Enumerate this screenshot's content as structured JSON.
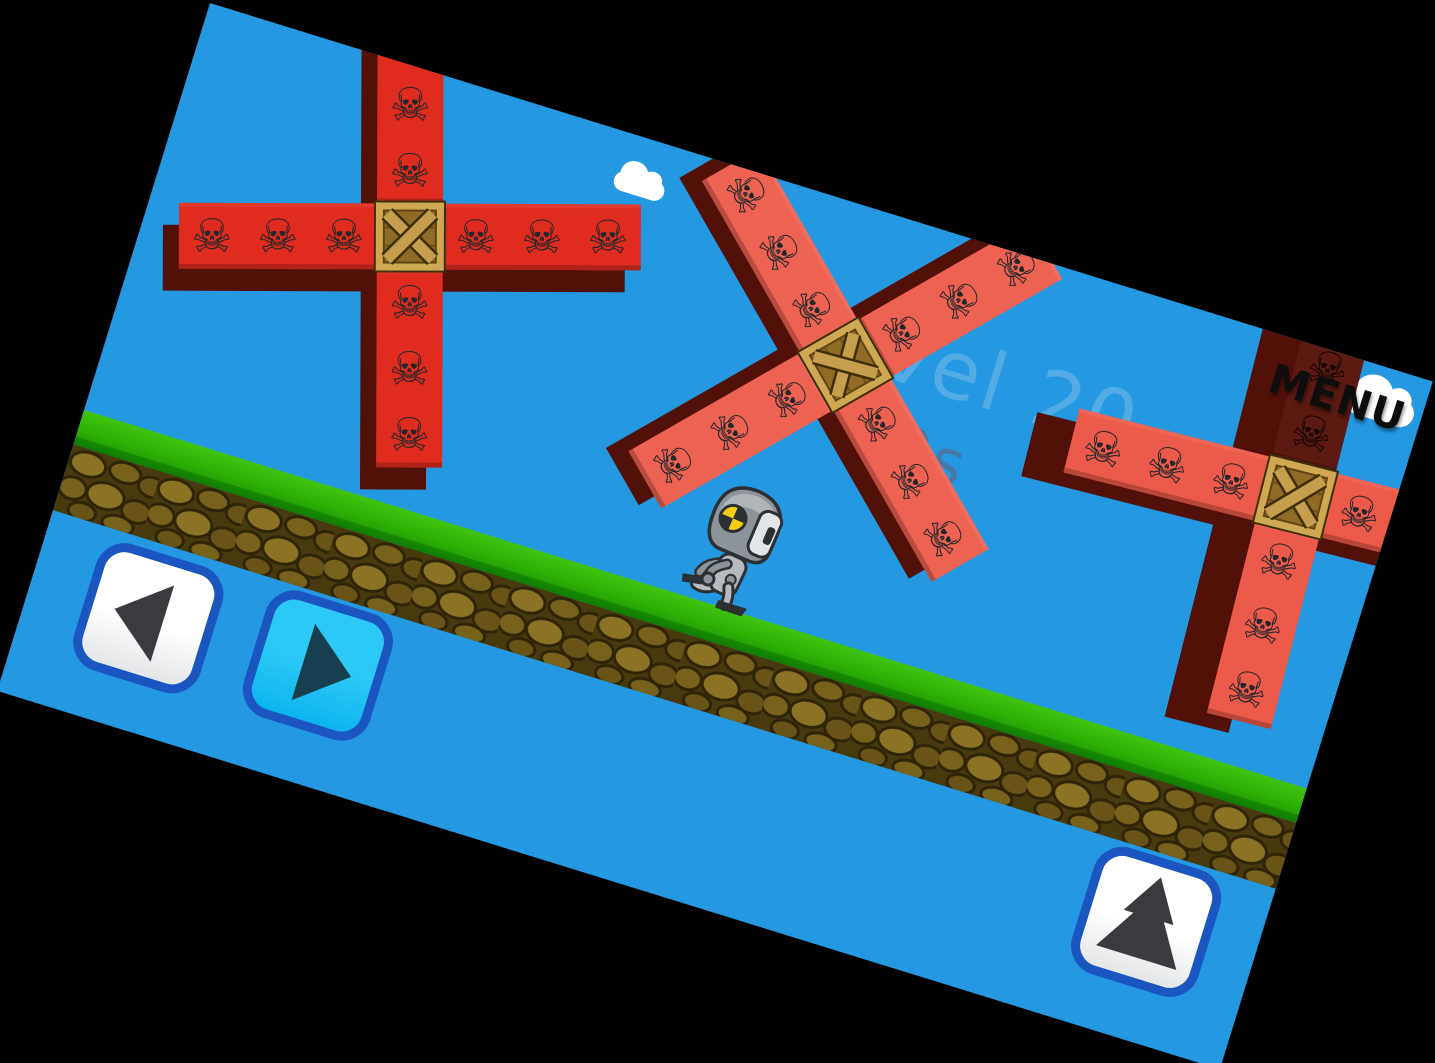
{
  "hud": {
    "level_label": "Level 20",
    "timer": "22s",
    "menu_label": "MENU"
  },
  "controls": {
    "left_button": "move-left",
    "right_button": "move-right (pressed)",
    "jump_button": "jump"
  },
  "icons": {
    "skull": "☠",
    "left_triangle": "left-triangle",
    "right_triangle": "right-triangle",
    "jump_arrow": "double-up-arrow"
  },
  "colors": {
    "sky": "#2598e2",
    "cloud": "#ffffff",
    "level_text": "#5fb0e8",
    "timer_text": "#4a78a3",
    "menu_text": "#0d0d0d",
    "grass_light": "#41c40c",
    "grass_dark": "#178a03",
    "dirt_base": "#473a0c",
    "stone_light": "#8a7324",
    "stone_mid": "#77621c",
    "stone_dark": "#675416",
    "stone_line": "#2e2506",
    "red_bright": "#e02c1e",
    "red_salmon": "#ee6252",
    "red_dark": "#521108",
    "red_shaded": "#5c1a12",
    "crate_frame": "#cfa854",
    "crate_wood": "#8f6b26",
    "crate_plank": "#c69e4e",
    "crate_outline": "#3f2f09",
    "skull": "#23272b",
    "btn_border": "#1a55c0",
    "btn_white_top": "#ffffff",
    "btn_white_bottom": "#e4e6e8",
    "btn_cyan_top": "#2cc9f7",
    "btn_cyan_bottom": "#0cb4ec",
    "tri_dark": "#3b3b3f",
    "tri_teal": "#16404f",
    "robot_body": "#b6bbc0",
    "robot_dark": "#2c3034",
    "robot_mid": "#8d9499",
    "robot_visor": "#e2e5e8",
    "robot_yellow": "#f2cf0e"
  }
}
